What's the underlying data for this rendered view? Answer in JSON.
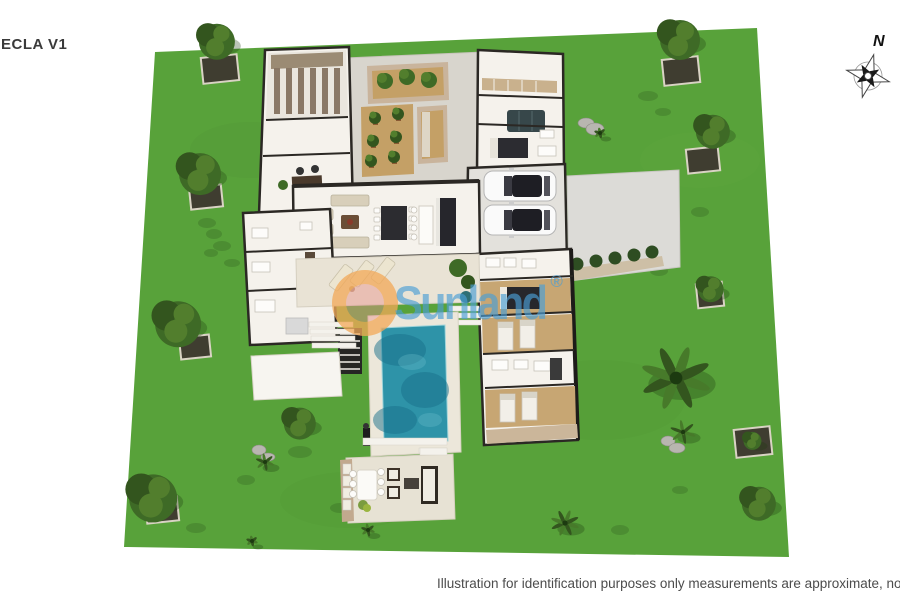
{
  "page": {
    "title_label": "ECLA V1",
    "caption": "Illustration for identification purposes only measurements are approximate, not to s",
    "compass_label": "N"
  },
  "watermark": {
    "text": "Sunland",
    "registered": "®"
  },
  "palette": {
    "lawn": "#58a23a",
    "lawn_shadow": "#1e3d12",
    "floor": "#f5f2ec",
    "wall": "#2b2824",
    "walkway": "#d8d5cd",
    "dirt": "#c4a066",
    "stone": "#c9b49c",
    "wood": "#c7a673",
    "drive": "#dcdbd7",
    "pool_deck": "#ece7da",
    "pool_water": "#2e93a8",
    "pool_deep": "#176f8a",
    "tree_dark": "#33551e",
    "tree_mid": "#3e6a26",
    "tree_light": "#527e2d",
    "furniture_dark": "#2c2c30",
    "cushion": "#e9e2cf",
    "text_dark": "#3a3a3a",
    "text_gray": "#4c4c4c",
    "watermark_blue": "rgba(74,158,212,0.66)",
    "watermark_orange": "rgba(245,178,70,0.55)",
    "watermark_pink": "rgba(233,146,140,0.45)"
  },
  "scene": {
    "features": [
      "lawn",
      "wine-cellar",
      "office",
      "central-courtyard",
      "olive-tree-patio",
      "raised-planters",
      "living-room",
      "dining-area",
      "kitchen",
      "interior-patio",
      "garage-two-cars",
      "driveway",
      "hedge-row",
      "bedrooms",
      "bathrooms",
      "sun-lounger-terrace",
      "swimming-pool",
      "pool-deck",
      "outdoor-shower",
      "garden-steps",
      "outdoor-lounge-patio",
      "perimeter-trees"
    ],
    "trees": [
      {
        "type": "tree",
        "x": 216,
        "y": 40,
        "r": 18,
        "planter": [
          202,
          56,
          36,
          26
        ]
      },
      {
        "type": "tree",
        "x": 679,
        "y": 38,
        "r": 20,
        "planter": [
          663,
          58,
          36,
          26
        ]
      },
      {
        "type": "tree",
        "x": 712,
        "y": 130,
        "r": 17,
        "planter": [
          687,
          148,
          32,
          24
        ]
      },
      {
        "type": "tree",
        "x": 710,
        "y": 288,
        "r": 13,
        "planter": [
          697,
          283,
          26,
          24
        ]
      },
      {
        "type": "bush",
        "x": 752,
        "y": 440,
        "r": 9,
        "planter": [
          735,
          428,
          36,
          28
        ]
      },
      {
        "type": "palm",
        "x": 676,
        "y": 378,
        "r": 32
      },
      {
        "type": "plant",
        "x": 683,
        "y": 432,
        "r": 11
      },
      {
        "type": "bush",
        "x": 758,
        "y": 502,
        "r": 17
      },
      {
        "type": "tree",
        "x": 152,
        "y": 496,
        "r": 24,
        "planter": [
          146,
          498,
          32,
          24
        ]
      },
      {
        "type": "bush",
        "x": 299,
        "y": 422,
        "r": 16
      },
      {
        "type": "plant",
        "x": 265,
        "y": 462,
        "r": 8
      },
      {
        "type": "tree",
        "x": 199,
        "y": 172,
        "r": 21,
        "planter": [
          190,
          186,
          32,
          22
        ]
      },
      {
        "type": "tree",
        "x": 177,
        "y": 322,
        "r": 23,
        "planter": [
          180,
          336,
          30,
          22
        ]
      },
      {
        "type": "palm",
        "x": 565,
        "y": 523,
        "r": 13
      },
      {
        "type": "plant",
        "x": 600,
        "y": 133,
        "r": 5
      },
      {
        "type": "plant",
        "x": 368,
        "y": 530,
        "r": 6
      },
      {
        "type": "plant",
        "x": 252,
        "y": 541,
        "r": 5
      }
    ],
    "rocks": [
      [
        586,
        123,
        8,
        5
      ],
      [
        595,
        129,
        9,
        6
      ],
      [
        668,
        441,
        7,
        5
      ],
      [
        677,
        448,
        8,
        5
      ],
      [
        259,
        450,
        7,
        5
      ],
      [
        268,
        457,
        7,
        4
      ]
    ],
    "lawn_shadows": [
      [
        207,
        223,
        9,
        5
      ],
      [
        214,
        234,
        8,
        5
      ],
      [
        222,
        246,
        9,
        5
      ],
      [
        211,
        253,
        7,
        4
      ],
      [
        232,
        263,
        8,
        4
      ],
      [
        263,
        301,
        8,
        5
      ],
      [
        270,
        312,
        9,
        5
      ],
      [
        277,
        323,
        8,
        4
      ],
      [
        648,
        96,
        10,
        5
      ],
      [
        663,
        112,
        8,
        4
      ],
      [
        700,
        212,
        9,
        5
      ],
      [
        659,
        271,
        9,
        5
      ],
      [
        604,
        182,
        7,
        4
      ],
      [
        246,
        480,
        9,
        5
      ],
      [
        196,
        528,
        10,
        5
      ],
      [
        300,
        452,
        12,
        6
      ],
      [
        340,
        508,
        10,
        5
      ],
      [
        620,
        530,
        9,
        5
      ],
      [
        680,
        490,
        8,
        4
      ]
    ]
  }
}
